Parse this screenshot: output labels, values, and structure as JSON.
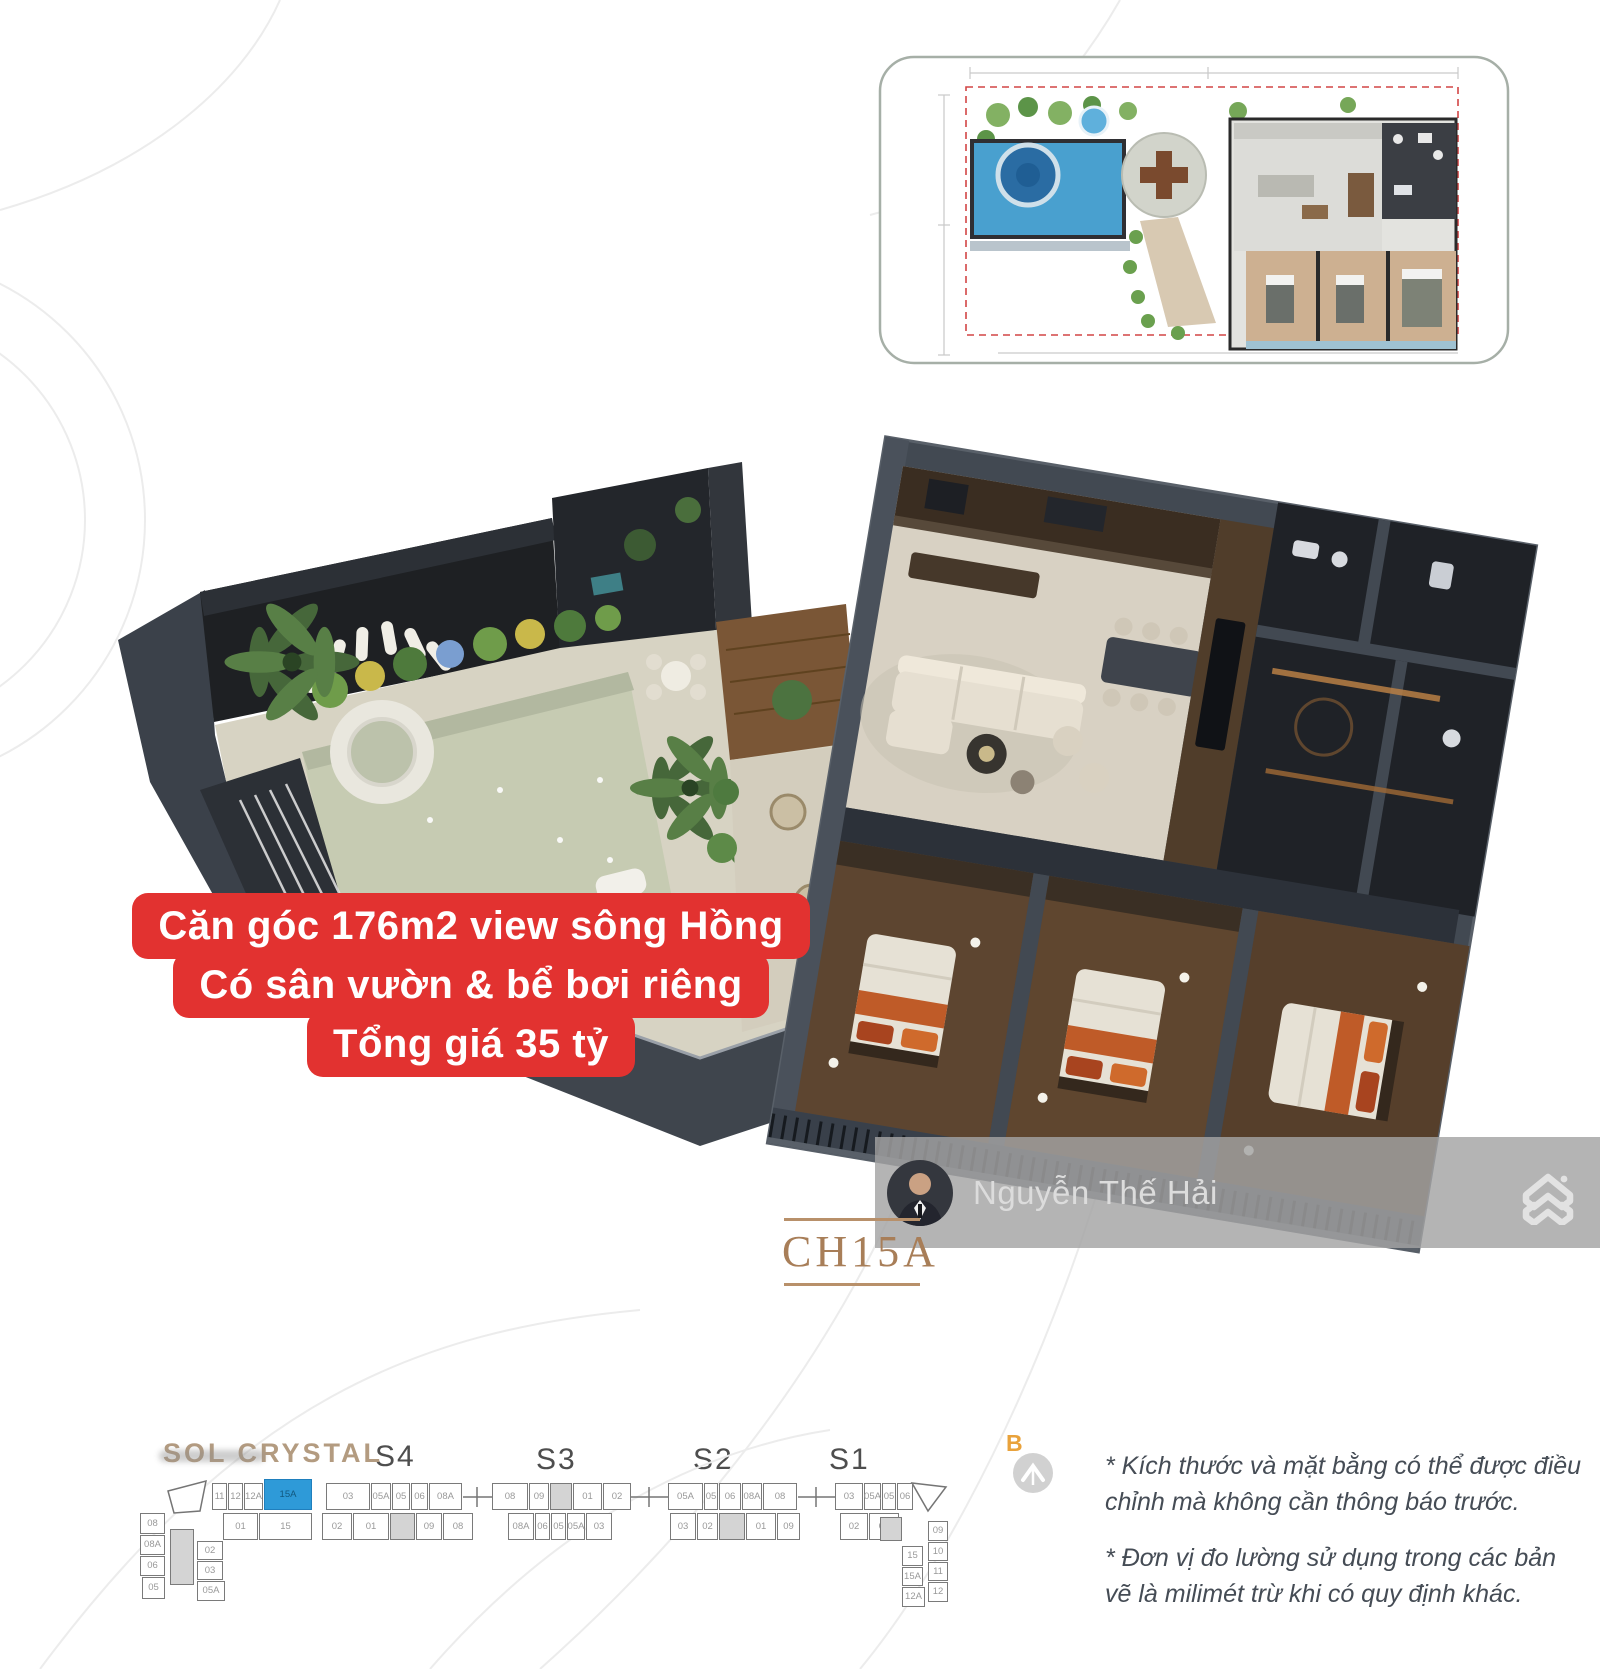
{
  "overlay": {
    "line1": "Căn góc 176m2 view sông Hồng",
    "line2": "Có sân vườn & bể bơi riêng",
    "line3": "Tổng giá 35 tỷ"
  },
  "unit_label": "CH15A",
  "watermark": {
    "agent_name": "Nguyễn Thế Hải"
  },
  "project": {
    "name": "SOL CRYSTAL",
    "sections": {
      "s4": "S4",
      "s3": "S3",
      "s2": "S2",
      "s1": "S1"
    },
    "compass_label": "B"
  },
  "notes": {
    "0": "* Kích thước và mặt bằng có thể được điều chỉnh mà không cần thông báo trước.",
    "1": "* Đơn vị đo lường sử dụng trong các bản vẽ là milimét trừ khi có quy định khác."
  },
  "colors": {
    "accent_red": "#e23230",
    "highlight_blue": "#2e9ad8",
    "bronze": "#a87e58",
    "bronze2": "#b39b80",
    "pool_green": "#c6cbb2",
    "wall_dark": "#424952"
  },
  "icons": {
    "logo": "house-chevrons-icon",
    "compass": "north-arrow-icon"
  },
  "strip": {
    "highlighted_unit": "15A",
    "boxes": [
      {
        "x": 72,
        "y": 10,
        "w": 15,
        "h": 27,
        "t": "11"
      },
      {
        "x": 88,
        "y": 10,
        "w": 15,
        "h": 27,
        "t": "12"
      },
      {
        "x": 104,
        "y": 10,
        "w": 19,
        "h": 27,
        "t": "12A"
      },
      {
        "x": 124,
        "y": 6,
        "w": 48,
        "h": 31,
        "t": "15A",
        "c": "b"
      },
      {
        "x": 186,
        "y": 10,
        "w": 44,
        "h": 27,
        "t": "03"
      },
      {
        "x": 231,
        "y": 10,
        "w": 20,
        "h": 27,
        "t": "05A"
      },
      {
        "x": 252,
        "y": 10,
        "w": 18,
        "h": 27,
        "t": "05"
      },
      {
        "x": 271,
        "y": 10,
        "w": 17,
        "h": 27,
        "t": "06"
      },
      {
        "x": 289,
        "y": 10,
        "w": 33,
        "h": 27,
        "t": "08A"
      },
      {
        "x": 352,
        "y": 10,
        "w": 36,
        "h": 27,
        "t": "08"
      },
      {
        "x": 389,
        "y": 10,
        "w": 20,
        "h": 27,
        "t": "09"
      },
      {
        "x": 410,
        "y": 10,
        "w": 22,
        "h": 27,
        "t": "",
        "c": "g"
      },
      {
        "x": 433,
        "y": 10,
        "w": 29,
        "h": 27,
        "t": "01"
      },
      {
        "x": 463,
        "y": 10,
        "w": 28,
        "h": 27,
        "t": "02"
      },
      {
        "x": 528,
        "y": 10,
        "w": 35,
        "h": 27,
        "t": "05A"
      },
      {
        "x": 564,
        "y": 10,
        "w": 14,
        "h": 27,
        "t": "05"
      },
      {
        "x": 579,
        "y": 10,
        "w": 22,
        "h": 27,
        "t": "06"
      },
      {
        "x": 602,
        "y": 10,
        "w": 20,
        "h": 27,
        "t": "08A"
      },
      {
        "x": 623,
        "y": 10,
        "w": 34,
        "h": 27,
        "t": "08"
      },
      {
        "x": 695,
        "y": 10,
        "w": 28,
        "h": 27,
        "t": "03"
      },
      {
        "x": 724,
        "y": 10,
        "w": 17,
        "h": 27,
        "t": "05A"
      },
      {
        "x": 742,
        "y": 10,
        "w": 14,
        "h": 27,
        "t": "05"
      },
      {
        "x": 757,
        "y": 10,
        "w": 16,
        "h": 27,
        "t": "06"
      },
      {
        "x": 83,
        "y": 40,
        "w": 35,
        "h": 27,
        "t": "01"
      },
      {
        "x": 119,
        "y": 40,
        "w": 53,
        "h": 27,
        "t": "15"
      },
      {
        "x": 182,
        "y": 40,
        "w": 30,
        "h": 27,
        "t": "02"
      },
      {
        "x": 213,
        "y": 40,
        "w": 36,
        "h": 27,
        "t": "01"
      },
      {
        "x": 250,
        "y": 40,
        "w": 25,
        "h": 27,
        "t": "",
        "c": "g"
      },
      {
        "x": 276,
        "y": 40,
        "w": 26,
        "h": 27,
        "t": "09"
      },
      {
        "x": 303,
        "y": 40,
        "w": 30,
        "h": 27,
        "t": "08"
      },
      {
        "x": 368,
        "y": 40,
        "w": 26,
        "h": 27,
        "t": "08A"
      },
      {
        "x": 395,
        "y": 40,
        "w": 15,
        "h": 27,
        "t": "06"
      },
      {
        "x": 411,
        "y": 40,
        "w": 15,
        "h": 27,
        "t": "05"
      },
      {
        "x": 427,
        "y": 40,
        "w": 18,
        "h": 27,
        "t": "05A"
      },
      {
        "x": 446,
        "y": 40,
        "w": 26,
        "h": 27,
        "t": "03"
      },
      {
        "x": 530,
        "y": 40,
        "w": 26,
        "h": 27,
        "t": "03"
      },
      {
        "x": 557,
        "y": 40,
        "w": 21,
        "h": 27,
        "t": "02"
      },
      {
        "x": 579,
        "y": 40,
        "w": 26,
        "h": 27,
        "t": "",
        "c": "g"
      },
      {
        "x": 606,
        "y": 40,
        "w": 30,
        "h": 27,
        "t": "01"
      },
      {
        "x": 637,
        "y": 40,
        "w": 23,
        "h": 27,
        "t": "09"
      },
      {
        "x": 700,
        "y": 40,
        "w": 28,
        "h": 27,
        "t": "02"
      },
      {
        "x": 729,
        "y": 40,
        "w": 30,
        "h": 27,
        "t": "01"
      },
      {
        "x": 30,
        "y": 56,
        "w": 24,
        "h": 56,
        "t": "",
        "c": "g"
      },
      {
        "x": 0,
        "y": 40,
        "w": 25,
        "h": 21,
        "t": "08"
      },
      {
        "x": 0,
        "y": 62,
        "w": 25,
        "h": 20,
        "t": "08A"
      },
      {
        "x": 0,
        "y": 83,
        "w": 25,
        "h": 20,
        "t": "06"
      },
      {
        "x": 2,
        "y": 104,
        "w": 23,
        "h": 22,
        "t": "05"
      },
      {
        "x": 57,
        "y": 68,
        "w": 26,
        "h": 19,
        "t": "02"
      },
      {
        "x": 57,
        "y": 88,
        "w": 26,
        "h": 19,
        "t": "03"
      },
      {
        "x": 57,
        "y": 108,
        "w": 28,
        "h": 20,
        "t": "05A"
      },
      {
        "x": 740,
        "y": 44,
        "w": 22,
        "h": 24,
        "t": "",
        "c": "g"
      },
      {
        "x": 762,
        "y": 73,
        "w": 21,
        "h": 20,
        "t": "15"
      },
      {
        "x": 762,
        "y": 94,
        "w": 21,
        "h": 19,
        "t": "15A"
      },
      {
        "x": 762,
        "y": 114,
        "w": 23,
        "h": 20,
        "t": "12A"
      },
      {
        "x": 788,
        "y": 48,
        "w": 20,
        "h": 20,
        "t": "09"
      },
      {
        "x": 788,
        "y": 69,
        "w": 20,
        "h": 19,
        "t": "10"
      },
      {
        "x": 788,
        "y": 89,
        "w": 20,
        "h": 19,
        "t": "11"
      },
      {
        "x": 788,
        "y": 109,
        "w": 20,
        "h": 20,
        "t": "12"
      }
    ]
  }
}
